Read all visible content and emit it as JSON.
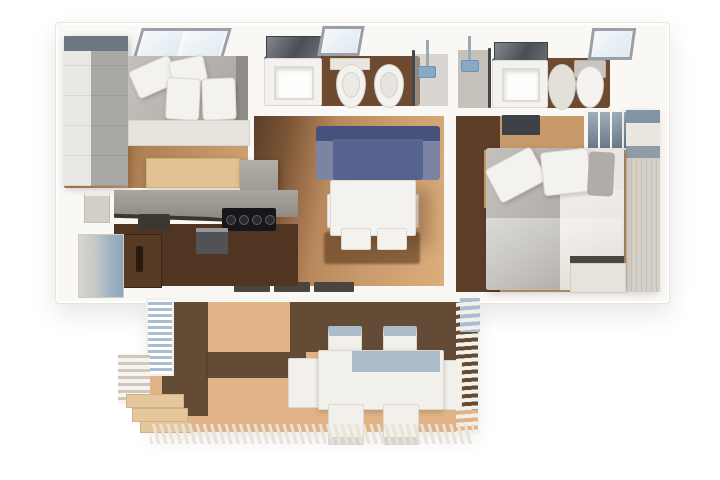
{
  "scene": {
    "type": "3d-floorplan-top-down-render",
    "width_px": 720,
    "height_px": 480,
    "background": "#ffffff"
  },
  "palette": {
    "bg": "#ffffff",
    "wall": "#faf8f5",
    "wall_edge": "#e9e4dc",
    "wood_mid": "#b9885c",
    "wood_dark": "#5c3e29",
    "wood_floor_bath": "#6e4a31",
    "deck_light": "#e0b487",
    "deck_dark": "#58422f",
    "sofa_back": "#46527c",
    "sofa_body": "#57648f",
    "sofa_arm": "#7b85a2",
    "shower_blue": "#87a9c7",
    "louver_blue": "#a9bed1",
    "table_band": "#adbccb",
    "cubby_blue": "#7e90a2",
    "wardrobe_wood": "#d6d1c8",
    "wardrobe_cap": "#8293a3",
    "fixture_white": "#f4f2ee",
    "pantry_brown": "#573a24"
  },
  "floorplan": {
    "rooms": [
      {
        "name": "bedroom-small",
        "furniture": [
          "wardrobe",
          "double-bed",
          "pillows",
          "roof-skylight",
          "desk"
        ]
      },
      {
        "name": "bathroom-main",
        "furniture": [
          "mirror",
          "vanity-sink",
          "roof-skylight",
          "toilet",
          "bidet",
          "glass-partition",
          "shower"
        ]
      },
      {
        "name": "bathroom-ensuite",
        "furniture": [
          "shower",
          "glass-partition",
          "mirror",
          "vanity-sink",
          "bidet",
          "toilet",
          "roof-skylight"
        ]
      },
      {
        "name": "kitchen",
        "furniture": [
          "entry-niche",
          "counter",
          "sink",
          "gas-cooktop",
          "tall-cabinet",
          "oven",
          "pantry-door",
          "frosted-glass-door"
        ]
      },
      {
        "name": "living-dining",
        "furniture": [
          "blue-sofa",
          "dining-table",
          "four-chairs",
          "rug",
          "sliding-door-sills"
        ]
      },
      {
        "name": "bedroom-master",
        "furniture": [
          "tv-panel",
          "ladder",
          "wall-cubbies",
          "wardrobe-column",
          "double-bed",
          "pillows",
          "bench"
        ]
      },
      {
        "name": "terrace",
        "furniture": [
          "louver-screen",
          "slat-stack",
          "wood-deck",
          "outdoor-table",
          "six-outdoor-chairs",
          "steps",
          "pergola-fringe"
        ]
      }
    ]
  }
}
